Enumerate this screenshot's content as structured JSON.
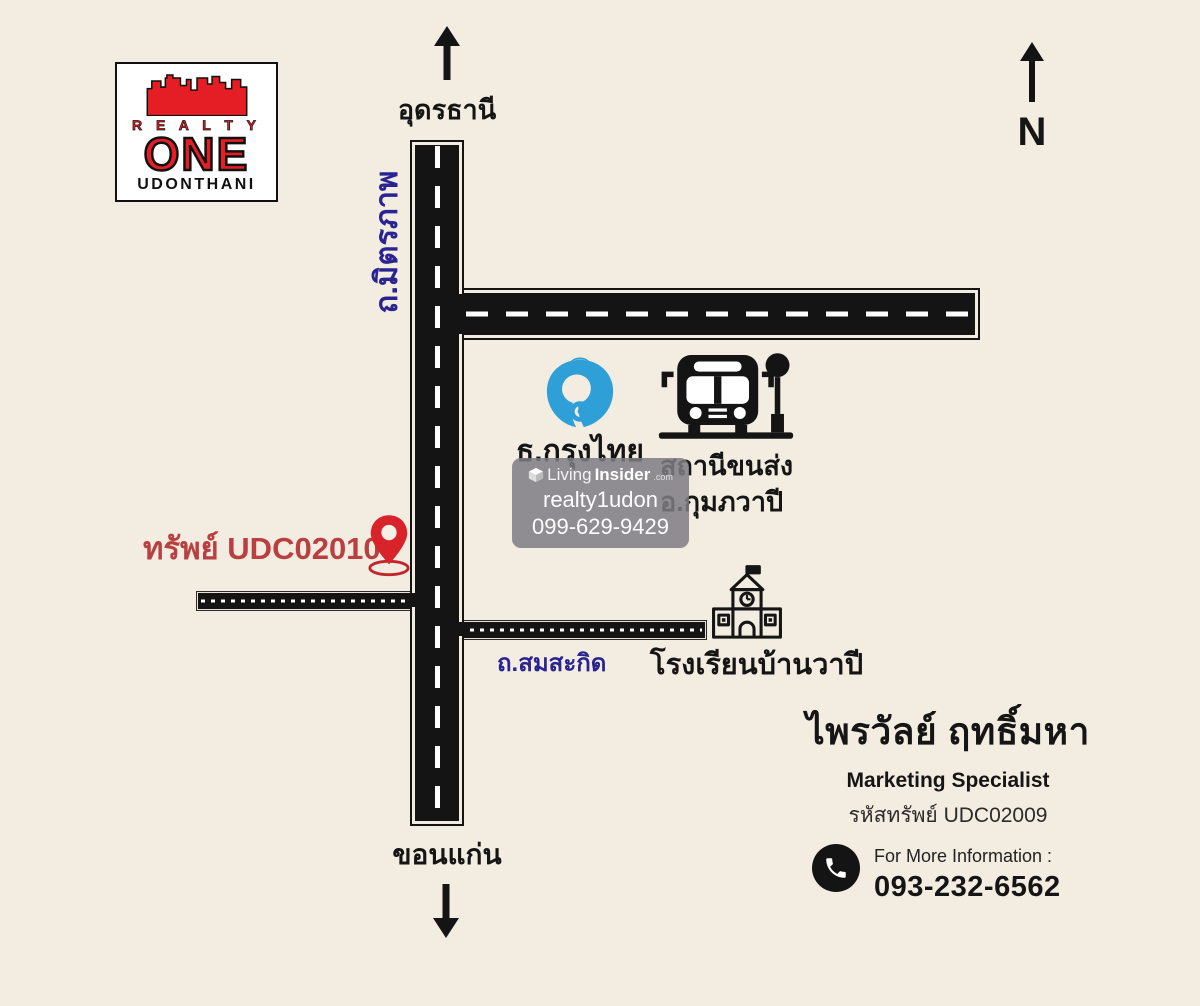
{
  "colors": {
    "background": "#f3ece1",
    "road": "#141414",
    "road_label_blue": "#2a2492",
    "brand_red": "#e51e25",
    "property_red": "#b94040",
    "pin_red": "#d8232a",
    "bank_blue": "#2f9fd8",
    "watermark_gray": "rgba(124,124,130,0.85)"
  },
  "logo": {
    "line1": "R E A L T Y",
    "line2": "ONE",
    "line3": "UDONTHANI"
  },
  "compass": {
    "letter": "N"
  },
  "map": {
    "north_city": "อุดรธานี",
    "south_city": "ขอนแก่น",
    "vertical_road": "ถ.มิตรภาพ",
    "small_road": "ถ.สมสะกิด",
    "bank_label": "ธ.กรุงไทย",
    "bus_label": "สถานีขนส่ง\nอ.กุมภวาปี",
    "school_label": "โรงเรียนบ้านวาปี",
    "property_label": "ทรัพย์ UDC02010"
  },
  "watermark": {
    "brand_light": "Living",
    "brand_bold": "Insider",
    "brand_tld": ".com",
    "account": "realty1udon",
    "phone": "099-629-9429"
  },
  "contact": {
    "name": "ไพรวัลย์ ฤทธิ์มหา",
    "role": "Marketing Specialist",
    "property_code": "รหัสทรัพย์ UDC02009",
    "info_label": "For More Information :",
    "phone": "093-232-6562"
  }
}
